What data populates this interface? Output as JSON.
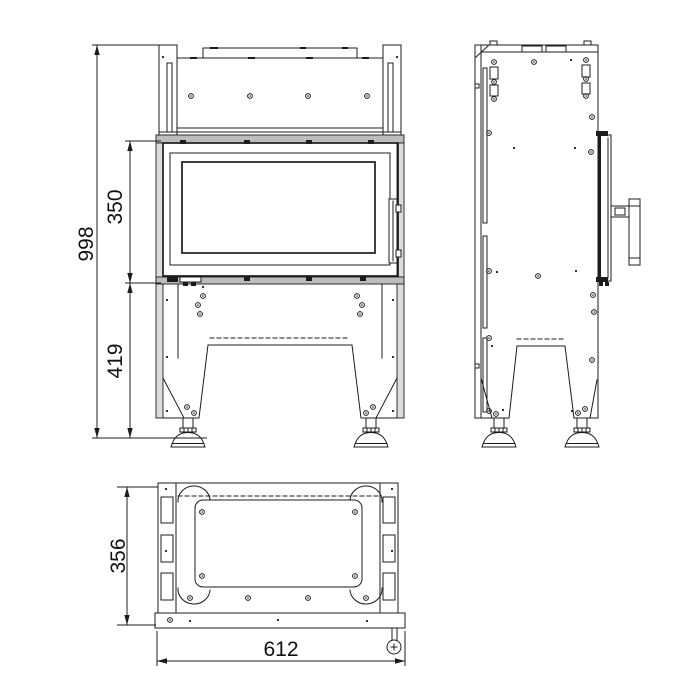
{
  "drawing": {
    "background_color": "#ffffff",
    "line_color": "#1c1c1c",
    "shaded_band_color": "#bdbdbd",
    "shaded_wall_color": "#dcdcdc",
    "dimensions": {
      "overall_height": "998",
      "door_section_height": "350",
      "base_section_height": "419",
      "depth": "356",
      "width": "612"
    }
  }
}
